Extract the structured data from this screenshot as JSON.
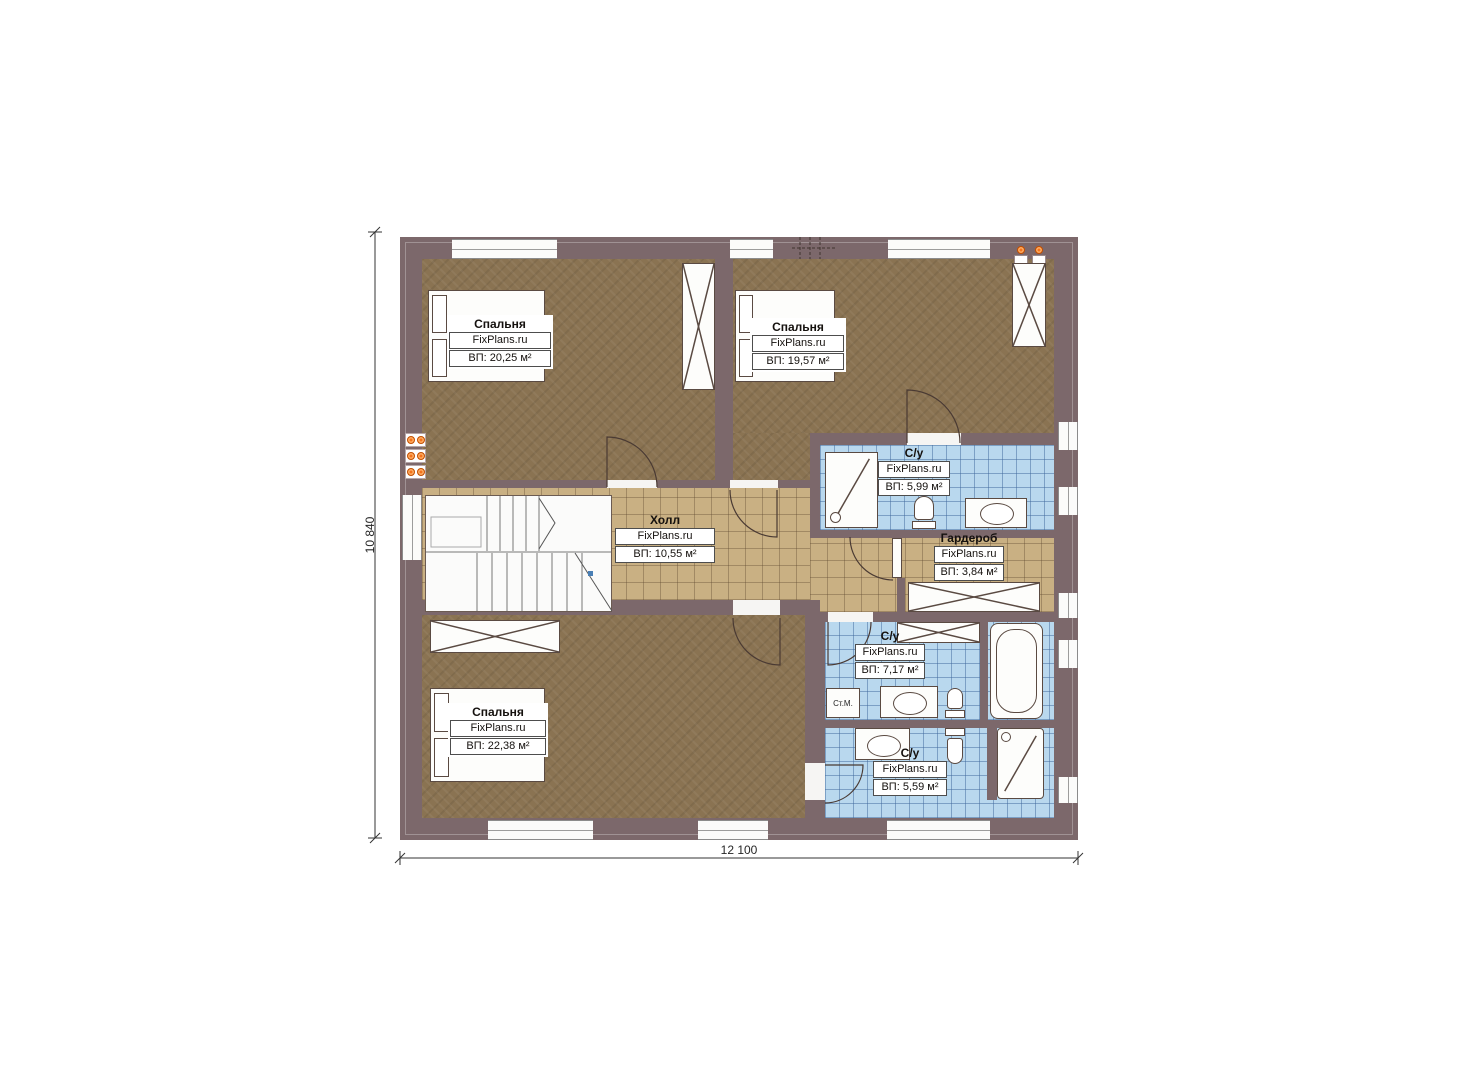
{
  "dimensions": {
    "width": "12 100",
    "height": "10 840"
  },
  "rooms": {
    "bedroom_tl": {
      "name": "Спальня",
      "brand": "FixPlans.ru",
      "area": "ВП: 20,25 м²"
    },
    "bedroom_tr": {
      "name": "Спальня",
      "brand": "FixPlans.ru",
      "area": "ВП: 19,57 м²"
    },
    "bathroom_top": {
      "name": "С/у",
      "brand": "FixPlans.ru",
      "area": "ВП: 5,99 м²"
    },
    "hall": {
      "name": "Холл",
      "brand": "FixPlans.ru",
      "area": "ВП: 10,55 м²"
    },
    "wardrobe": {
      "name": "Гардероб",
      "brand": "FixPlans.ru",
      "area": "ВП: 3,84 м²"
    },
    "bedroom_b": {
      "name": "Спальня",
      "brand": "FixPlans.ru",
      "area": "ВП: 22,38 м²"
    },
    "bathroom_mid": {
      "name": "С/у",
      "brand": "FixPlans.ru",
      "area": "ВП: 7,17 м²"
    },
    "bathroom_bot": {
      "name": "С/у",
      "brand": "FixPlans.ru",
      "area": "ВП: 5,59 м²"
    }
  },
  "labels": {
    "washing_machine": "Ст.М."
  },
  "colors": {
    "wall": "#7c686b",
    "bedroom_floor": "#8a7352",
    "hall_floor": "#c9b083",
    "bathroom_floor": "#b9d8ee",
    "radiator": "#f4731c",
    "furniture_outline": "#5a4a42"
  }
}
